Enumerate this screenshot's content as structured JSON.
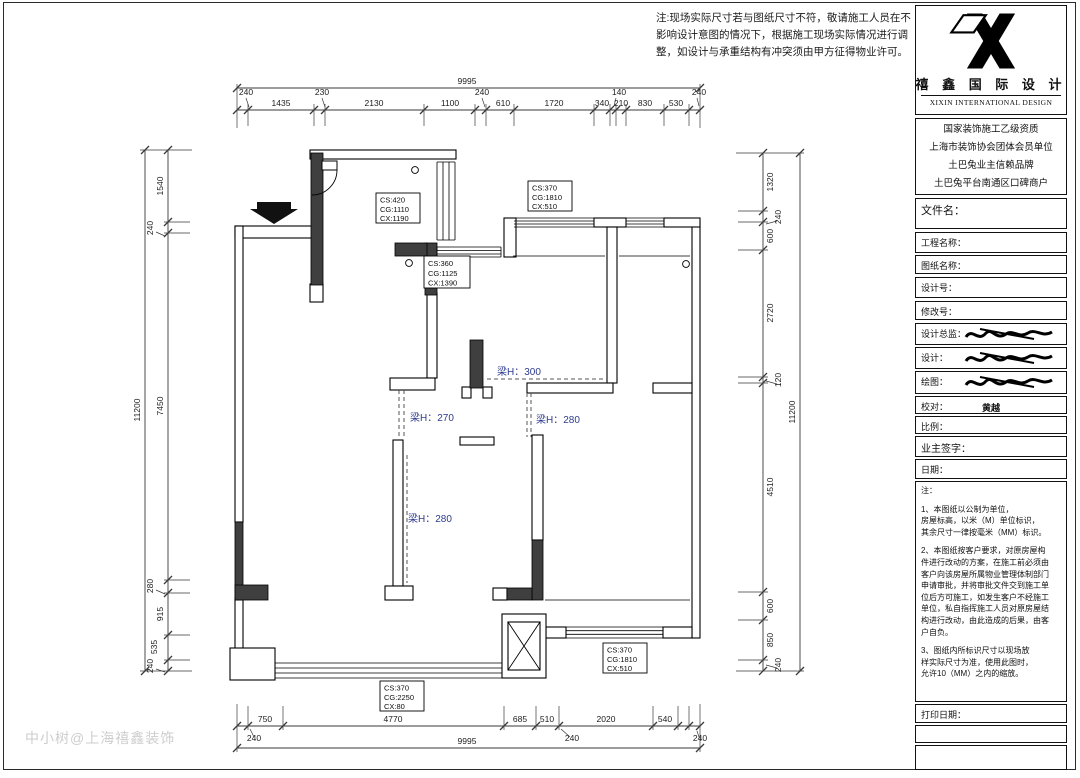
{
  "sheet": {
    "note_top": "注:现场实际尺寸若与图纸尺寸不符，敬请施工人员在不\n影响设计意图的情况下，根据施工现场实际情况进行调\n整，如设计与承重结构有冲突须由甲方征得物业许可。",
    "watermark": "中小树@上海禧鑫装饰"
  },
  "title_block": {
    "company_cn": "禧 鑫 国 际 设 计",
    "company_en": "XIXIN INTERNATIONAL DESIGN",
    "credentials": [
      "国家装饰施工乙级资质",
      "上海市装饰协会团体会员单位",
      "土巴兔业主信赖品牌",
      "土巴兔平台南通区口碑商户"
    ],
    "file_label": "文件名：",
    "project_label": "工程名称：",
    "drawing_label": "图纸名称：",
    "design_no_label": "设计号：",
    "revision_label": "修改号：",
    "director_label": "设计总监：",
    "design_label": "设计：",
    "draft_label": "绘图：",
    "check_label": "校对：",
    "check_value": "黄越",
    "scale_label": "比例：",
    "owner_label": "业主签字：",
    "date_label": "日期：",
    "notes_title": "注：",
    "note_1": "1、本图纸以公制为单位，\n房屋标高，以米（M）单位标识，\n其余尺寸一律按毫米（MM）标识。",
    "note_2": "2、本图纸按客户要求，对原房屋构\n件进行改动的方案，在施工前必须由\n客户向该房屋所属物业管理体制部门\n申请审批，并将审批文件交到施工单\n位后方可施工，如发生客户不经施工\n单位，私自指挥施工人员对原房屋结\n构进行改动，由此造成的后果，由客\n户自负。",
    "note_3": "3、图纸内所标识尺寸以现场放\n样实际尺寸为准，使用此图时，\n允许10（MM）之内的缩放。",
    "print_label": "打印日期："
  },
  "plan": {
    "dims_top": {
      "overall": "9995",
      "s": [
        "240",
        "1435",
        "230",
        "2130",
        "1100",
        "240",
        "610",
        "1720",
        "340",
        "140",
        "210",
        "830",
        "530",
        "240"
      ]
    },
    "dims_bottom": {
      "overall": "9995",
      "s": [
        "750",
        "4770",
        "685",
        "510",
        "2020",
        "540"
      ],
      "off": [
        "240",
        "240",
        "240"
      ]
    },
    "dims_left": {
      "overall": "11200",
      "s": [
        "1540",
        "240",
        "7450",
        "280",
        "915",
        "535",
        "240"
      ]
    },
    "dims_right": {
      "overall": "11200",
      "s": [
        "1320",
        "240",
        "600",
        "2720",
        "120",
        "4510",
        "600",
        "850",
        "240"
      ]
    },
    "windows": [
      {
        "l1": "CS:420",
        "l2": "CG:1110",
        "l3": "CX:1190"
      },
      {
        "l1": "CS:370",
        "l2": "CG:1810",
        "l3": "CX:510"
      },
      {
        "l1": "CS:360",
        "l2": "CG:1125",
        "l3": "CX:1390"
      },
      {
        "l1": "CS:370",
        "l2": "CG:1810",
        "l3": "CX:510"
      },
      {
        "l1": "CS:370",
        "l2": "CG:2250",
        "l3": "CX:80"
      }
    ],
    "beams": [
      "梁H：300",
      "梁H：270",
      "梁H：280",
      "梁H：280"
    ]
  }
}
